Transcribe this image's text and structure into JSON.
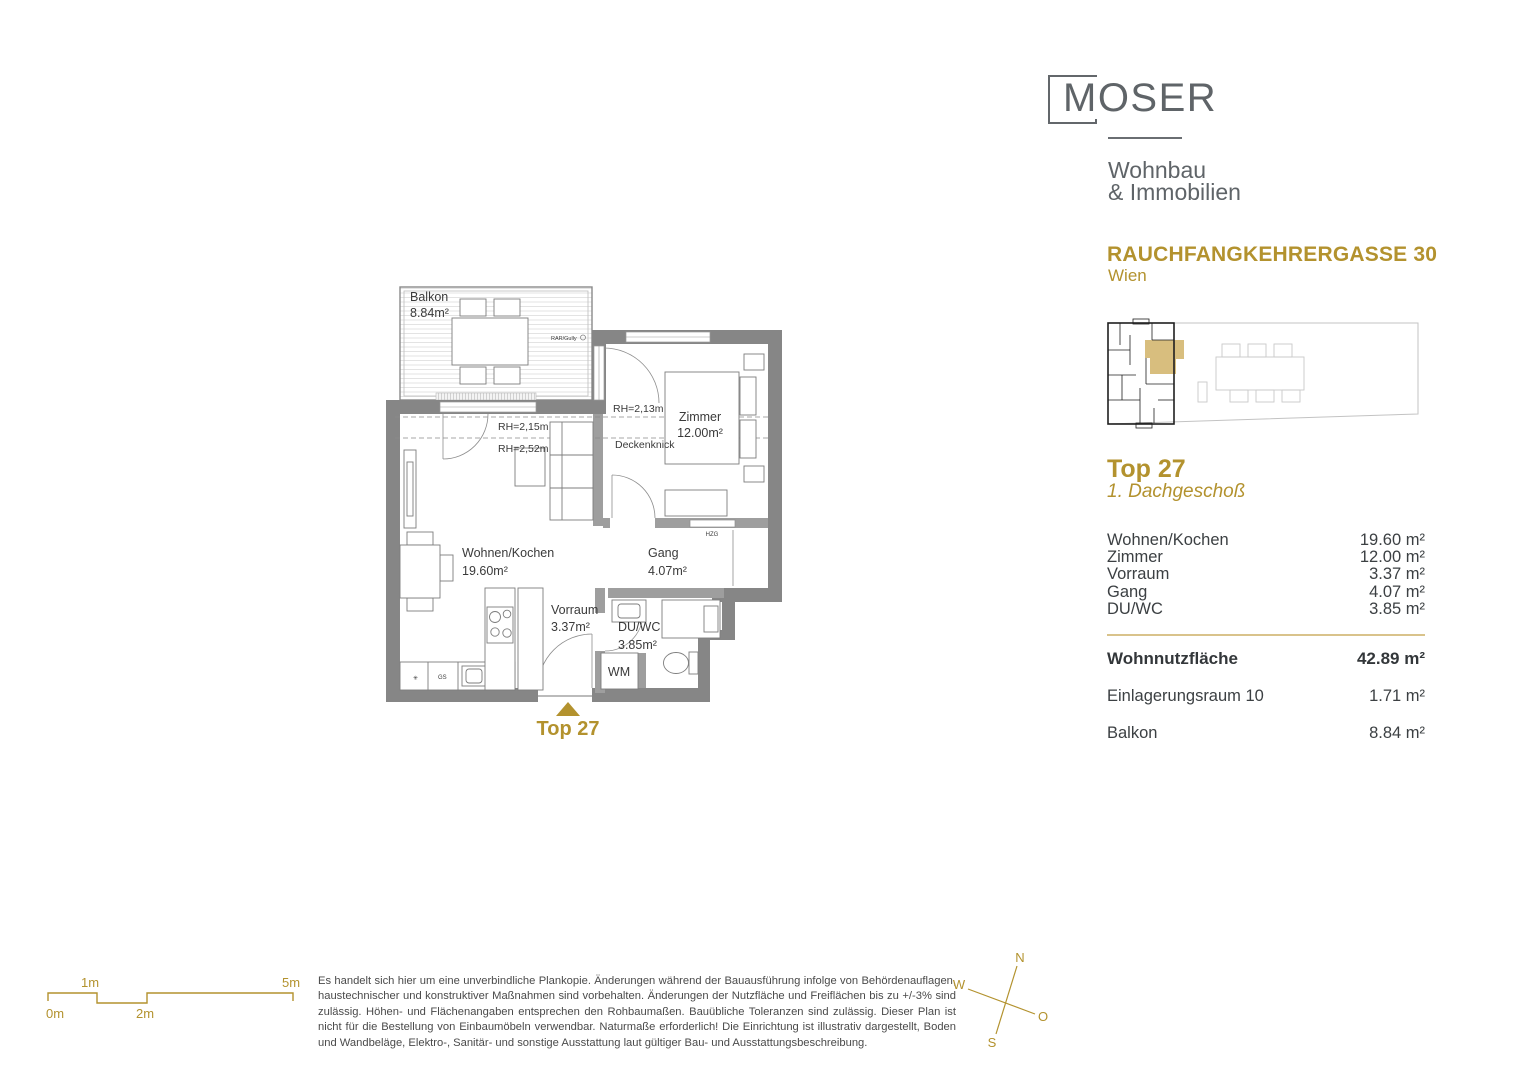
{
  "colors": {
    "gold": "#B3922E",
    "gold_divider": "#D9C38B",
    "highlight_fill": "#D8BE7E",
    "wall_dark": "#868686",
    "wall_light": "#A5A5A5",
    "logo_gray": "#5F6468",
    "text_dark": "#3C4043"
  },
  "brand": {
    "logo": "MOSER",
    "subtitle_line1": "Wohnbau",
    "subtitle_line2": "& Immobilien"
  },
  "project": {
    "street": "RAUCHFANGKEHRERGASSE 30",
    "city": "Wien"
  },
  "unit": {
    "name": "Top 27",
    "floor": "1. Dachgeschoß"
  },
  "areas": {
    "rows": [
      {
        "label": "Wohnen/Kochen",
        "value": "19.60 m²"
      },
      {
        "label": "Zimmer",
        "value": "12.00 m²"
      },
      {
        "label": "Vorraum",
        "value": "3.37 m²"
      },
      {
        "label": "Gang",
        "value": "4.07 m²"
      },
      {
        "label": "DU/WC",
        "value": "3.85 m²"
      }
    ],
    "total": {
      "label": "Wohnnutzfläche",
      "value": "42.89 m²"
    },
    "extras": [
      {
        "label": "Einlagerungsraum 10",
        "value": "1.71 m²"
      },
      {
        "label": "Balkon",
        "value": "8.84 m²"
      }
    ]
  },
  "plan": {
    "balkon_label": "Balkon",
    "balkon_area": "8.84m²",
    "zimmer_label": "Zimmer",
    "zimmer_area": "12.00m²",
    "wohnen_label": "Wohnen/Kochen",
    "wohnen_area": "19.60m²",
    "gang_label": "Gang",
    "gang_area": "4.07m²",
    "vorraum_label": "Vorraum",
    "vorraum_area": "3.37m²",
    "duwc_label": "DU/WC",
    "duwc_area": "3.85m²",
    "wm_label": "WM",
    "rh_215": "RH=2,15m",
    "rh_252": "RH=2,52m",
    "rh_213": "RH=2,13m",
    "deckenknick": "Deckenknick",
    "hzg": "HZG",
    "rar_gully": "RAR/Gully",
    "gs": "GS",
    "star": "✳",
    "entry_label": "Top 27"
  },
  "scale_bar": {
    "l0": "0m",
    "l1": "1m",
    "l2": "2m",
    "l5": "5m"
  },
  "compass": {
    "n": "N",
    "o": "O",
    "s": "S",
    "w": "W"
  },
  "disclaimer": "Es handelt sich hier um eine unverbindliche Plankopie. Änderungen während der Bauausführung infolge von Behördenauflagen, haustechnischer und konstruktiver Maßnahmen sind vorbehalten. Änderungen der Nutzfläche und Freiflächen bis zu +/-3% sind zulässig. Höhen- und Flächenangaben entsprechen den Rohbaumaßen. Bauübliche Toleranzen sind zulässig. Dieser Plan ist nicht für die Bestellung von Einbaumöbeln verwendbar. Naturmaße erforderlich! Die Einrichtung ist illustrativ dargestellt, Boden und Wandbeläge, Elektro-, Sanitär- und sonstige Ausstattung laut gültiger Bau- und Ausstattungsbeschreibung."
}
